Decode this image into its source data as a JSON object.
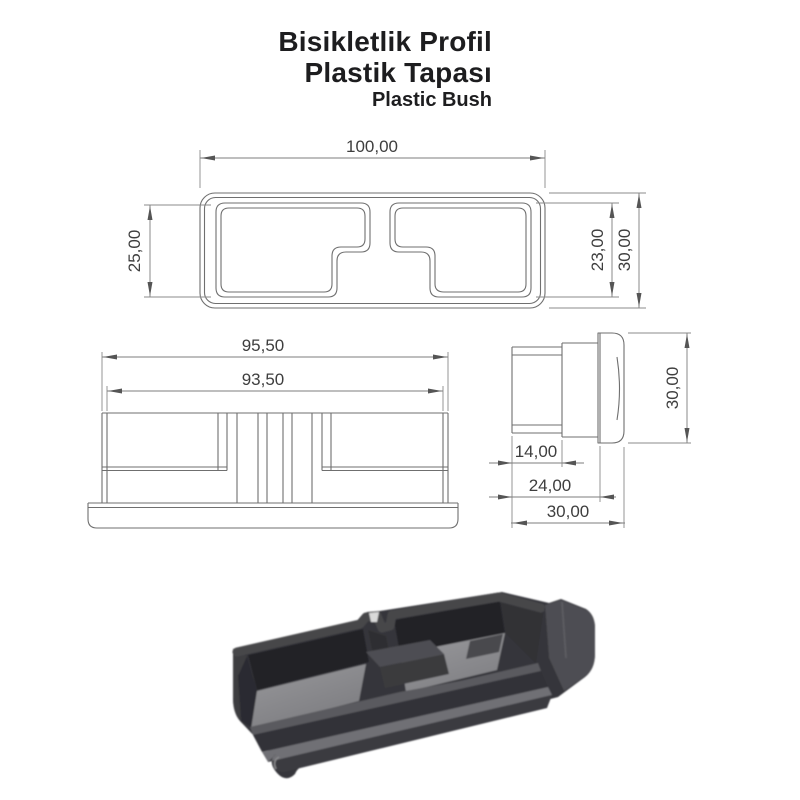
{
  "page": {
    "background": "#ffffff"
  },
  "title": {
    "line1": "Bisikletlik Profil",
    "line2": "Plastik Tapası",
    "line3": "Plastic Bush",
    "text_color": "#1d1d1f"
  },
  "views": {
    "top": {
      "dims": {
        "width": "100,00",
        "pocket_left_height": "25,00",
        "pocket_right_height": "23,00",
        "outer_height": "30,00"
      }
    },
    "front": {
      "dims": {
        "outer_width": "95,50",
        "inner_width": "93,50"
      }
    },
    "side": {
      "dims": {
        "flange_height": "30,00",
        "insert_depth": "14,00",
        "body_depth": "24,00",
        "total_depth": "30,00"
      }
    }
  },
  "drawing_style": {
    "line_color": "#6f6f6f",
    "dim_line_color": "#7d7d7d",
    "dim_text_color": "#3e3e3e"
  },
  "render_3d": {
    "body_dark": "#2a2a2e",
    "body_mid": "#36363b",
    "rim_color": "#46464a",
    "floor_light": "#8e8e92",
    "flange_light": "#4d4d52"
  }
}
